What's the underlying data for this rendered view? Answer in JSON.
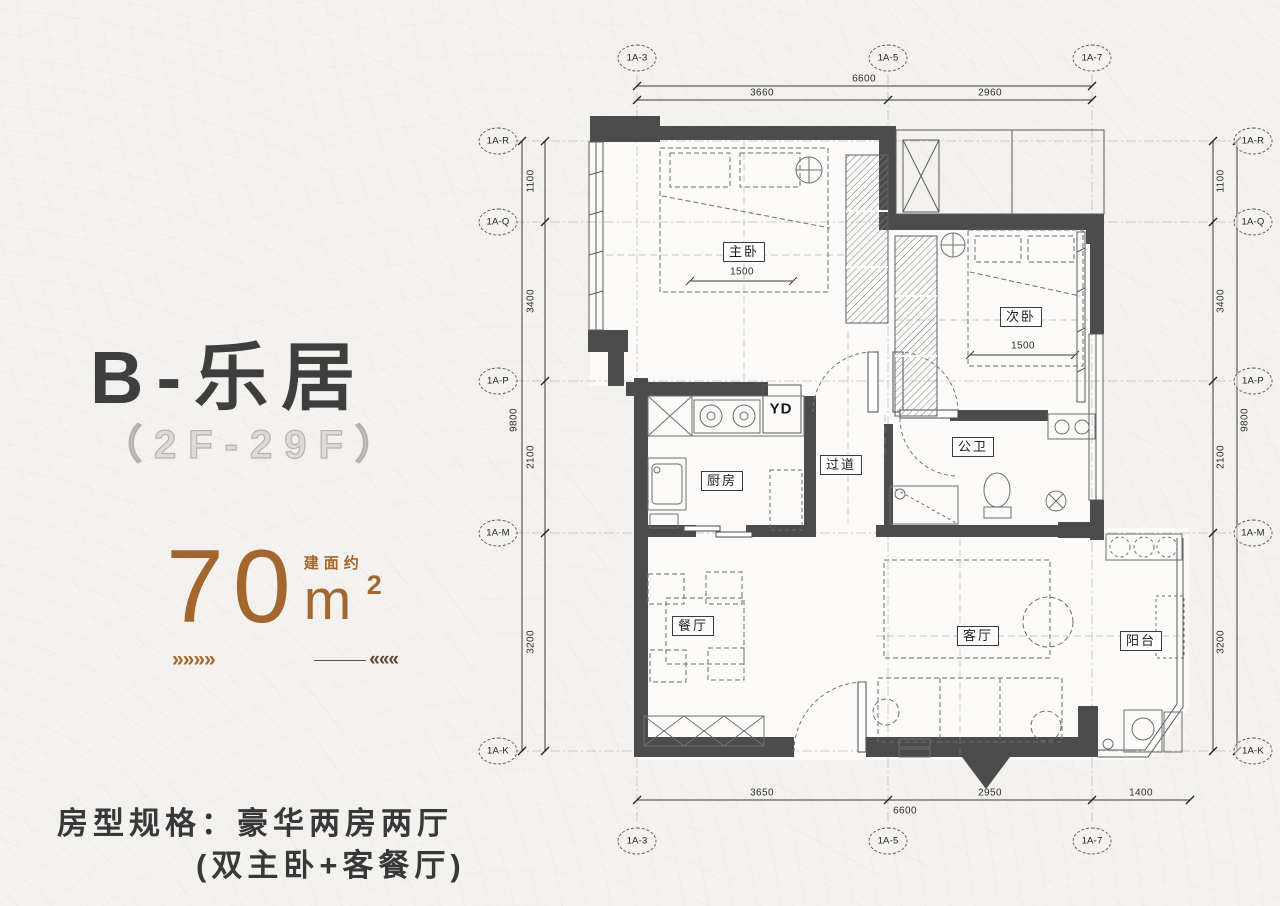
{
  "panel": {
    "title": "B-乐居",
    "floors": "（2F-29F）",
    "area": {
      "value": "70",
      "unit": "m",
      "sup": "2",
      "note": "建面约"
    },
    "deco_left": "»»»»",
    "deco_right": "«««",
    "spec_line1": "房型规格：豪华两房两厅",
    "spec_line2": "(双主卧+客餐厅)"
  },
  "colors": {
    "accent_brown": "#a2662e",
    "title_dark": "#3e3e3e",
    "wall": "#4c4c4c",
    "background": "#f4f2ef"
  },
  "plan": {
    "grid_cols": [
      "1A-3",
      "1A-5",
      "1A-7"
    ],
    "grid_rows": [
      "1A-R",
      "1A-Q",
      "1A-P",
      "1A-M",
      "1A-K"
    ],
    "dims": {
      "top_total": "6600",
      "top_segments": [
        "3660",
        "2960"
      ],
      "bottom_segments": [
        "3650",
        "2950",
        "1400"
      ],
      "bottom_total": "6600",
      "side_segments": [
        "1100",
        "3400",
        "2100",
        "3200"
      ],
      "side_total": "9800"
    },
    "rooms": [
      {
        "name": "master-bedroom",
        "label": "主卧"
      },
      {
        "name": "second-bedroom",
        "label": "次卧"
      },
      {
        "name": "kitchen",
        "label": "厨房"
      },
      {
        "name": "laundry",
        "label": "YD"
      },
      {
        "name": "hallway",
        "label": "过道"
      },
      {
        "name": "bathroom",
        "label": "公卫"
      },
      {
        "name": "dining-room",
        "label": "餐厅"
      },
      {
        "name": "living-room",
        "label": "客厅"
      },
      {
        "name": "balcony",
        "label": "阳台"
      }
    ],
    "bed_dims": {
      "master": "1500",
      "second": "1500"
    }
  }
}
